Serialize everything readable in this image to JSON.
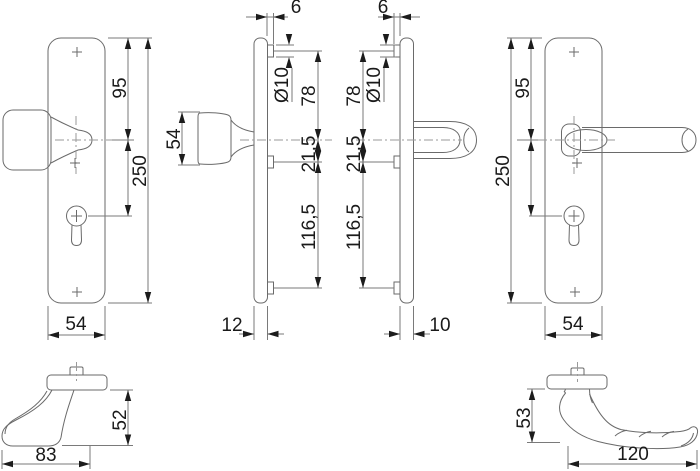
{
  "title": "Security door handle set technical drawing",
  "colors": {
    "background": "#ffffff",
    "outline": "#6a6a6a",
    "dimension_line": "#7a7a7a",
    "centerline": "#9a9a9a",
    "text": "#1a1a1a"
  },
  "views": {
    "knob_plate_front": {
      "height_top_to_handle": "95",
      "total_height": "250",
      "plate_width": "54"
    },
    "knob_side": {
      "knob_height": "54"
    },
    "knob_plate_profile": {
      "spindle_offset": "6",
      "bolt_diameter": "Ø10",
      "top_bolt_to_handle": "78",
      "handle_to_mid_bolt": "21,5",
      "mid_to_bottom_bolt": "116,5",
      "plate_depth": "12"
    },
    "lever_plate_profile": {
      "spindle_offset": "6",
      "bolt_diameter": "Ø10",
      "top_bolt_to_handle": "78",
      "handle_to_mid_bolt": "21,5",
      "mid_to_bottom_bolt": "116,5",
      "plate_depth": "10"
    },
    "lever_plate_front": {
      "height_top_to_handle": "95",
      "total_height": "250",
      "plate_width": "54"
    },
    "knob_detail": {
      "knob_height": "52",
      "knob_length": "83"
    },
    "lever_detail": {
      "lever_height": "53",
      "lever_length": "120"
    }
  }
}
